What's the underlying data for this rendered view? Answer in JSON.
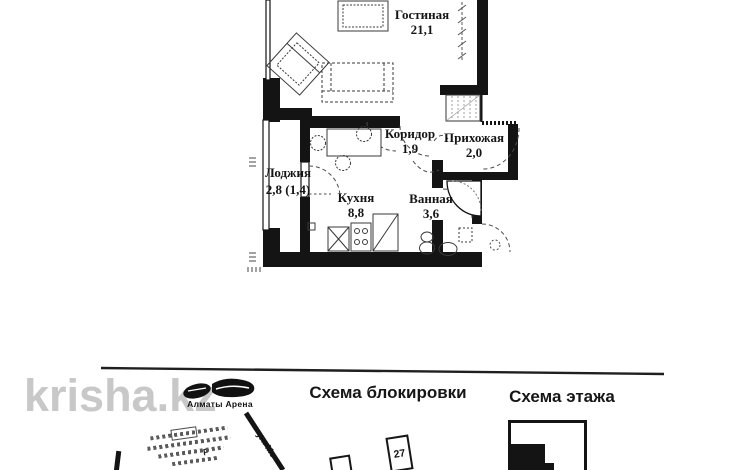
{
  "colors": {
    "ink": "#151515",
    "wall": "#141414",
    "watermark": "#c8c8c8",
    "furniture": "#3a3a3a"
  },
  "floor_plan": {
    "rooms": [
      {
        "name": "Гостиная",
        "area": "21,1"
      },
      {
        "name": "Коридор",
        "area": "1,9"
      },
      {
        "name": "Прихожая",
        "area": "2,0"
      },
      {
        "name": "Лоджия",
        "area": "2,8 (1,4)"
      },
      {
        "name": "Кухня",
        "area": "8,8"
      },
      {
        "name": "Ванная",
        "area": "3,6"
      }
    ]
  },
  "watermark": {
    "text": "krisha.kz"
  },
  "logo": {
    "text": "Алматы Арена"
  },
  "schemes": {
    "block_title": "Схема блокировки",
    "floor_title": "Схема этажа"
  },
  "site_plan": {
    "building_number": "27",
    "street_label": "ул. Мо",
    "parking_label": "Р"
  }
}
